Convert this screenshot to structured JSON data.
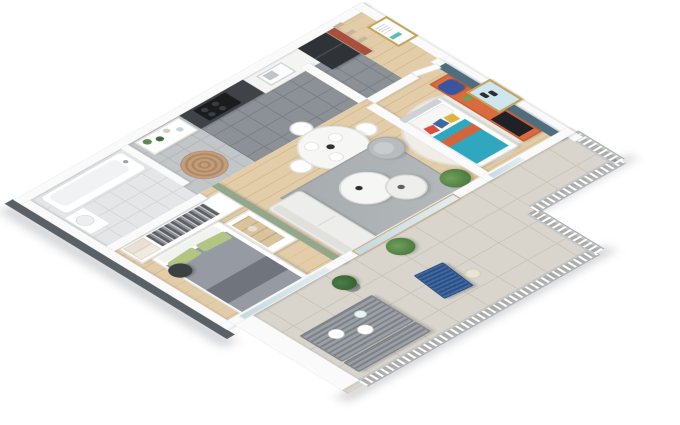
{
  "meta": {
    "type": "isometric-3d-floorplan-render",
    "description": "Cutaway 3D render of a one/two-bedroom apartment with terrace, viewed isometrically on a white background",
    "background": "#ffffff"
  },
  "colors": {
    "wall": "#fafafa",
    "wallEdge": "#e2e2e2",
    "slab": "#596066",
    "wood": "#e3cda9",
    "woodLine": "#d3b88e",
    "tileKitchen": "#8b9196",
    "tileKitchenLine": "#767c81",
    "tileBath": "#e4e6e7",
    "tileBathLine": "#d2d5d7",
    "tileCorridor": "#c2c6c9",
    "tileCorridorLine": "#b1b5b8",
    "tileTerrace": "#d9d5cc",
    "tileTerraceLine": "#c7c3ba",
    "sageWall": "#93a78d",
    "slateWall": "#4e6d7e",
    "redWall": "#a8503c",
    "shelfWood": "#c8b49a",
    "cabinetDark": "#3f4347",
    "counterWhite": "#f4f4f3",
    "cooktop": "#1a1c1e",
    "fridge": "#2f3337",
    "sofa": "#ededeb",
    "armchair": "#b9bcbe",
    "rugGray": "#a6abae",
    "rugSpiral": "#c29c7c",
    "rugSpiralLine": "#ae8862",
    "rugRound": "#f0ede7",
    "tableWhite": "#f6f6f4",
    "duvetGray": "#959aa3",
    "duvetDark": "#70757d",
    "pillowGreen": "#b2c583",
    "poufDark": "#3c4043",
    "bedTeal": "#2fa8bf",
    "bedOrange": "#d2653c",
    "sideboardOrange": "#c75a33",
    "sideboardOrangeTop": "#d96b3f",
    "tvBlack": "#1e2125",
    "backpackBlue": "#3a55a0",
    "plantGreen": "#5d8a4e",
    "plantDark": "#3f6b38",
    "potDark": "#3a3d3f",
    "outdoorMetal": "#9aa0a5",
    "outdoorMetalDark": "#7c8288",
    "chairBlue": "#3f69a3",
    "railingPost": "#ffffff",
    "lantern": "#e8e3d2",
    "frameGold": "#c2a35a",
    "artBlue": "#cfe6ee",
    "artMark": "#2a2d32",
    "dresserWood": "#d9c29c",
    "shadow": "rgba(75,80,86,0.25)"
  },
  "scene": {
    "rooms": [
      {
        "name": "bathroom",
        "floor": "light-gray-tile",
        "items": [
          "bathtub",
          "washbasin"
        ]
      },
      {
        "name": "corridor",
        "floor": "gray-tile",
        "items": [
          "plant-etagere-shelf",
          "spiral-round-rug"
        ]
      },
      {
        "name": "kitchen",
        "floor": "dark-gray-tile",
        "items": [
          "dark-cabinet-run",
          "cooktop-4-burners",
          "sink",
          "black-fridge"
        ]
      },
      {
        "name": "entry-hall",
        "floor": "wood",
        "items": [
          "red-accent-wall",
          "wood-shoe-shelves",
          "framed-poster-teal",
          "entry-door"
        ]
      },
      {
        "name": "living-dining-room",
        "floor": "wood",
        "items": [
          "round-white-dining-table",
          "four-white-chairs",
          "gray-area-rug",
          "two-round-coffee-tables",
          "white-sofa",
          "gray-armchair",
          "monstera-plant",
          "sliding-glass-door",
          "sage-green-partition"
        ]
      },
      {
        "name": "master-bedroom",
        "floor": "wood",
        "items": [
          "open-wardrobe-with-clothes",
          "double-bed-gray-green",
          "dark-pouf",
          "white-dresser",
          "window-band"
        ]
      },
      {
        "name": "kids-bedroom",
        "floor": "wood",
        "items": [
          "slate-blue-accent-wall",
          "orange-sideboard",
          "tv",
          "blue-backpack",
          "teal-bed-orange-stripe",
          "round-white-rug",
          "framed-art-gold",
          "window"
        ]
      },
      {
        "name": "terrace",
        "floor": "beige-tile",
        "items": [
          "slatted-metal-table",
          "slatted-metal-bench",
          "white-tableware",
          "boxwood-topiary",
          "blue-slatted-chair",
          "leafy-potted-plant",
          "lantern",
          "white-baluster-railing",
          "parapet-wall"
        ]
      }
    ]
  }
}
